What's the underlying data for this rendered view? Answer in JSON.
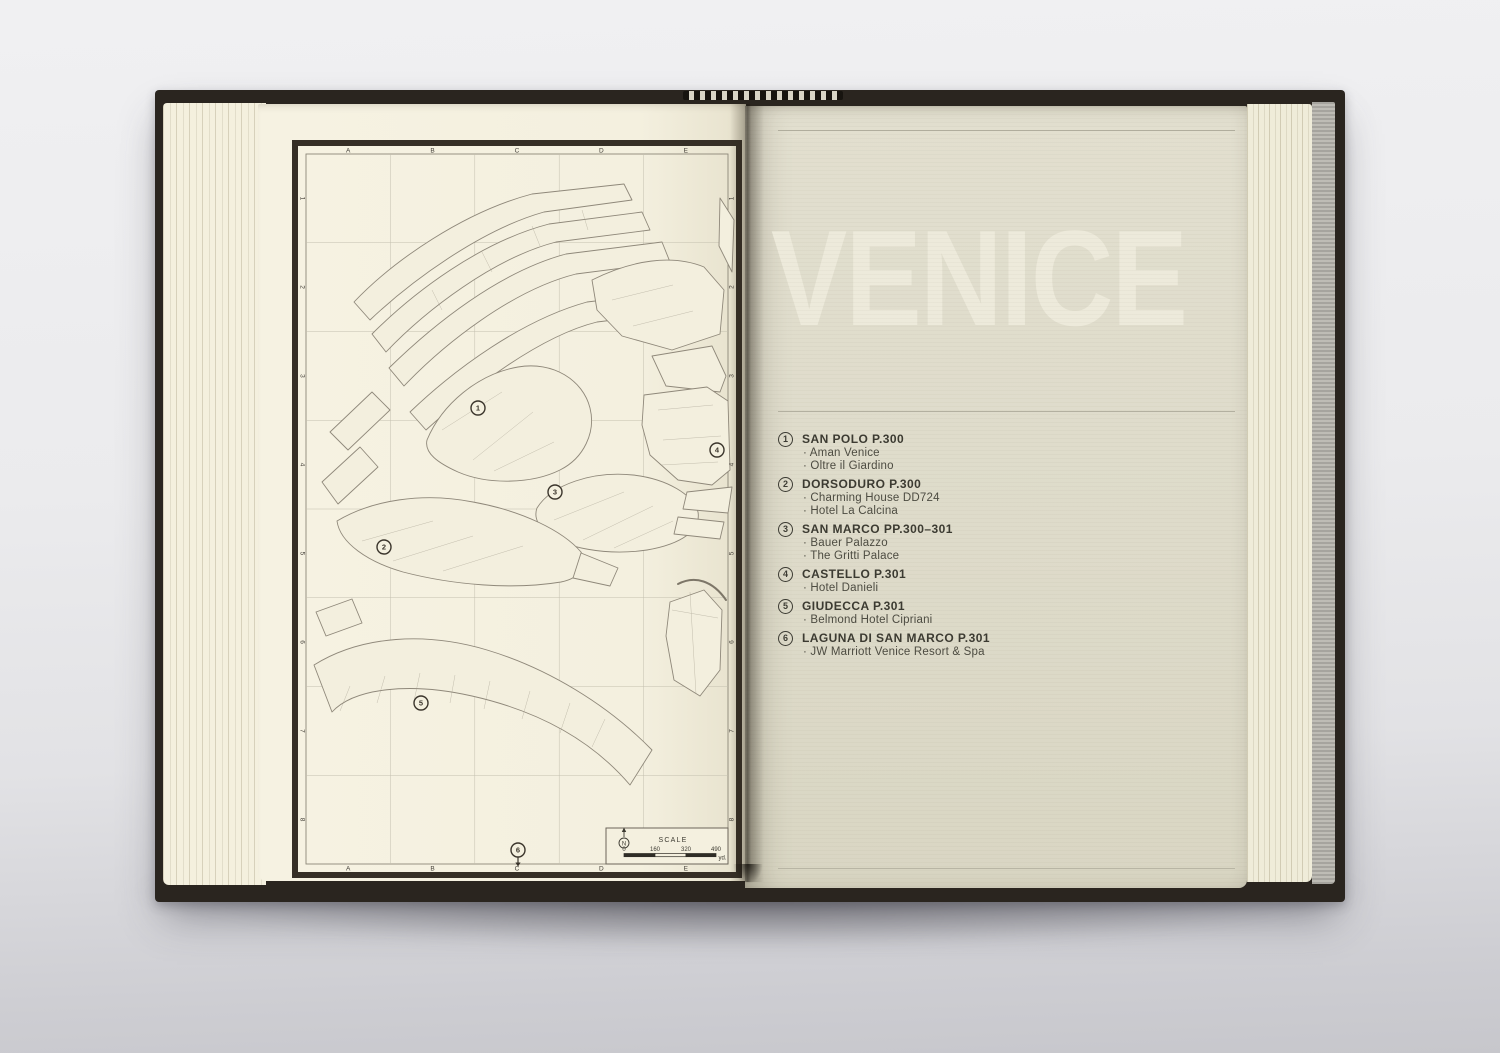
{
  "photo": {
    "background_color": "#ebebee",
    "cover_color": "#2a251f",
    "left_page_color": "#f4f0df",
    "right_page_color": "#dedbca",
    "title_ink_color": "#edeadb",
    "text_ink_color": "#3b3a31",
    "map_line_color": "#8f887a"
  },
  "map": {
    "grid_columns": [
      "A",
      "B",
      "C",
      "D",
      "E"
    ],
    "grid_rows": [
      "1",
      "2",
      "3",
      "4",
      "5",
      "6",
      "7",
      "8"
    ],
    "markers": [
      {
        "label": "1",
        "x": 186,
        "y": 268
      },
      {
        "label": "2",
        "x": 92,
        "y": 407
      },
      {
        "label": "3",
        "x": 263,
        "y": 352
      },
      {
        "label": "4",
        "x": 425,
        "y": 310
      },
      {
        "label": "5",
        "x": 129,
        "y": 563
      },
      {
        "label": "6",
        "x": 226,
        "y": 710,
        "arrow": "down"
      }
    ],
    "scale": {
      "title": "SCALE",
      "north_label": "N",
      "tick_labels": [
        "0",
        "160",
        "320",
        "490"
      ],
      "unit": "yd."
    }
  },
  "right_page": {
    "title": "VENICE",
    "hotel_bullet": "·",
    "districts": [
      {
        "number": "1",
        "title": "SAN POLO P.300",
        "hotels": [
          "Aman Venice",
          "Oltre il Giardino"
        ]
      },
      {
        "number": "2",
        "title": "DORSODURO P.300",
        "hotels": [
          "Charming House DD724",
          "Hotel La Calcina"
        ]
      },
      {
        "number": "3",
        "title": "SAN MARCO PP.300–301",
        "hotels": [
          "Bauer Palazzo",
          "The Gritti Palace"
        ]
      },
      {
        "number": "4",
        "title": "CASTELLO P.301",
        "hotels": [
          "Hotel Danieli"
        ]
      },
      {
        "number": "5",
        "title": "GIUDECCA P.301",
        "hotels": [
          "Belmond Hotel Cipriani"
        ]
      },
      {
        "number": "6",
        "title": "LAGUNA DI SAN MARCO P.301",
        "hotels": [
          "JW Marriott Venice Resort & Spa"
        ]
      }
    ]
  }
}
